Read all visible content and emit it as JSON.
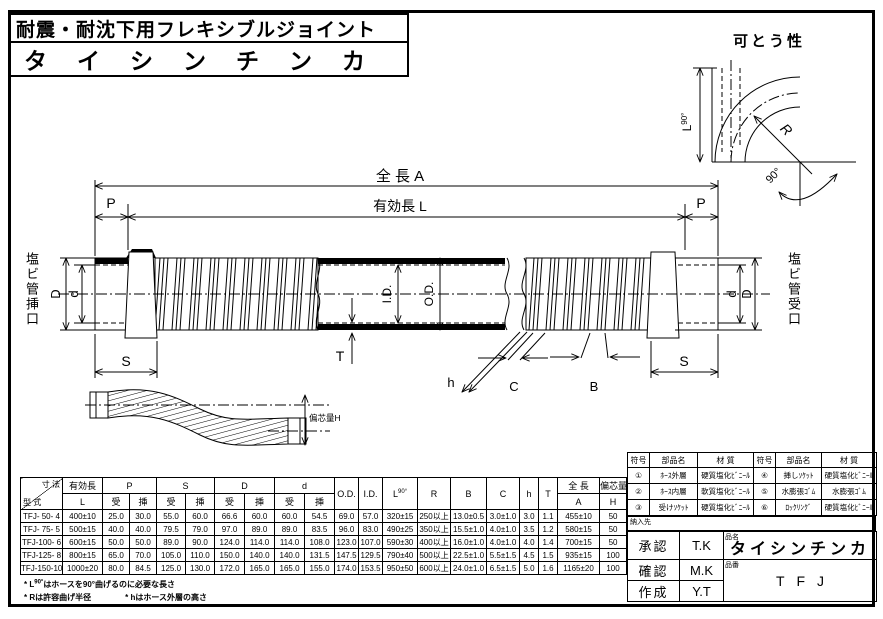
{
  "colors": {
    "line": "#000000",
    "background": "#ffffff"
  },
  "title": {
    "line1": "耐震・耐沈下用フレキシブルジョイント",
    "line2": "タイシンチンカ"
  },
  "flex_diagram": {
    "title": "可とう性",
    "l90_label": "L",
    "l90_sup": "90°",
    "r_label": "R",
    "angle_label": "90°"
  },
  "drawing": {
    "dim_total_length": "全 長  A",
    "dim_effective_length": "有効長  L",
    "dim_p_left": "P",
    "dim_p_right": "P",
    "dim_s_left": "S",
    "dim_s_right": "S",
    "dim_D_left": "D",
    "dim_d_left": "d",
    "dim_d_right": "d",
    "dim_D_right": "D",
    "dim_id": "I.D.",
    "dim_od": "O.D.",
    "dim_t": "T",
    "dim_h": "h",
    "dim_c": "C",
    "dim_b": "B",
    "left_port_label": "塩ビ管挿口",
    "right_port_label": "塩ビ管受口",
    "offset_label": "偏芯量H"
  },
  "spec_table": {
    "header": {
      "size": "寸 法",
      "model": "型 式",
      "effective_length": "有効長",
      "effective_length_sym": "L",
      "p": "P",
      "s": "S",
      "d_upper": "D",
      "d_lower": "d",
      "receive": "受",
      "insert": "挿",
      "od": "O.D.",
      "id": "I.D.",
      "l90": "L",
      "l90_sup": "90°",
      "r": "R",
      "b": "B",
      "c": "C",
      "h": "h",
      "t": "T",
      "total_length": "全 長",
      "total_length_sym": "A",
      "eccentric": "偏芯量",
      "eccentric_sym": "H"
    },
    "rows": [
      [
        "TFJ- 50- 4",
        "400±10",
        "25.0",
        "30.0",
        "55.0",
        "60.0",
        "66.6",
        "60.0",
        "60.0",
        "54.5",
        "69.0",
        "57.0",
        "320±15",
        "250以上",
        "13.0±0.5",
        "3.0±1.0",
        "3.0",
        "1.1",
        "455±10",
        "50"
      ],
      [
        "TFJ- 75- 5",
        "500±15",
        "40.0",
        "40.0",
        "79.5",
        "79.0",
        "97.0",
        "89.0",
        "89.0",
        "83.5",
        "96.0",
        "83.0",
        "490±25",
        "350以上",
        "15.5±1.0",
        "4.0±1.0",
        "3.5",
        "1.2",
        "580±15",
        "50"
      ],
      [
        "TFJ-100- 6",
        "600±15",
        "50.0",
        "50.0",
        "89.0",
        "90.0",
        "124.0",
        "114.0",
        "114.0",
        "108.0",
        "123.0",
        "107.0",
        "590±30",
        "400以上",
        "16.0±1.0",
        "4.0±1.0",
        "4.0",
        "1.4",
        "700±15",
        "50"
      ],
      [
        "TFJ-125- 8",
        "800±15",
        "65.0",
        "70.0",
        "105.0",
        "110.0",
        "150.0",
        "140.0",
        "140.0",
        "131.5",
        "147.5",
        "129.5",
        "790±40",
        "500以上",
        "22.5±1.0",
        "5.5±1.5",
        "4.5",
        "1.5",
        "935±15",
        "100"
      ],
      [
        "TFJ-150-10",
        "1000±20",
        "80.0",
        "84.5",
        "125.0",
        "130.0",
        "172.0",
        "165.0",
        "165.0",
        "155.0",
        "174.0",
        "153.5",
        "950±50",
        "600以上",
        "24.0±1.0",
        "6.5±1.5",
        "5.0",
        "1.6",
        "1165±20",
        "100"
      ]
    ]
  },
  "notes": {
    "note1_prefix": "* L",
    "note1_sup": "90°",
    "note1_text": "はホースを90°曲げるのに必要な長さ",
    "note2": "* Rは許容曲げ半径",
    "note3": "* hはホース外層の高さ"
  },
  "parts_table": {
    "headers": [
      "符号",
      "部品名",
      "材 質",
      "符号",
      "部品名",
      "材 質"
    ],
    "rows": [
      [
        "①",
        "ﾎｰｽ外層",
        "硬質塩化ﾋﾞﾆｰﾙ",
        "④",
        "挿しｿｹｯﾄ",
        "硬質塩化ﾋﾞﾆｰﾙ"
      ],
      [
        "②",
        "ﾎｰｽ内層",
        "軟質塩化ﾋﾞﾆｰﾙ",
        "⑤",
        "水膨張ｺﾞﾑ",
        "水膨張ｺﾞﾑ"
      ],
      [
        "③",
        "受けｿｹｯﾄ",
        "硬質塩化ﾋﾞﾆｰﾙ",
        "⑥",
        "ﾛｯｸﾘﾝｸﾞ",
        "硬質塩化ﾋﾞﾆｰﾙ"
      ]
    ]
  },
  "delivery_label": "納入先",
  "approval": {
    "rows": [
      {
        "label": "承認",
        "value": "T.K"
      },
      {
        "label": "確認",
        "value": "M.K"
      },
      {
        "label": "作成",
        "value": "Y.T"
      }
    ],
    "product_name_label": "品名",
    "product_name": "タイシンチンカ",
    "product_code_label": "品番",
    "product_code": "TFJ"
  }
}
